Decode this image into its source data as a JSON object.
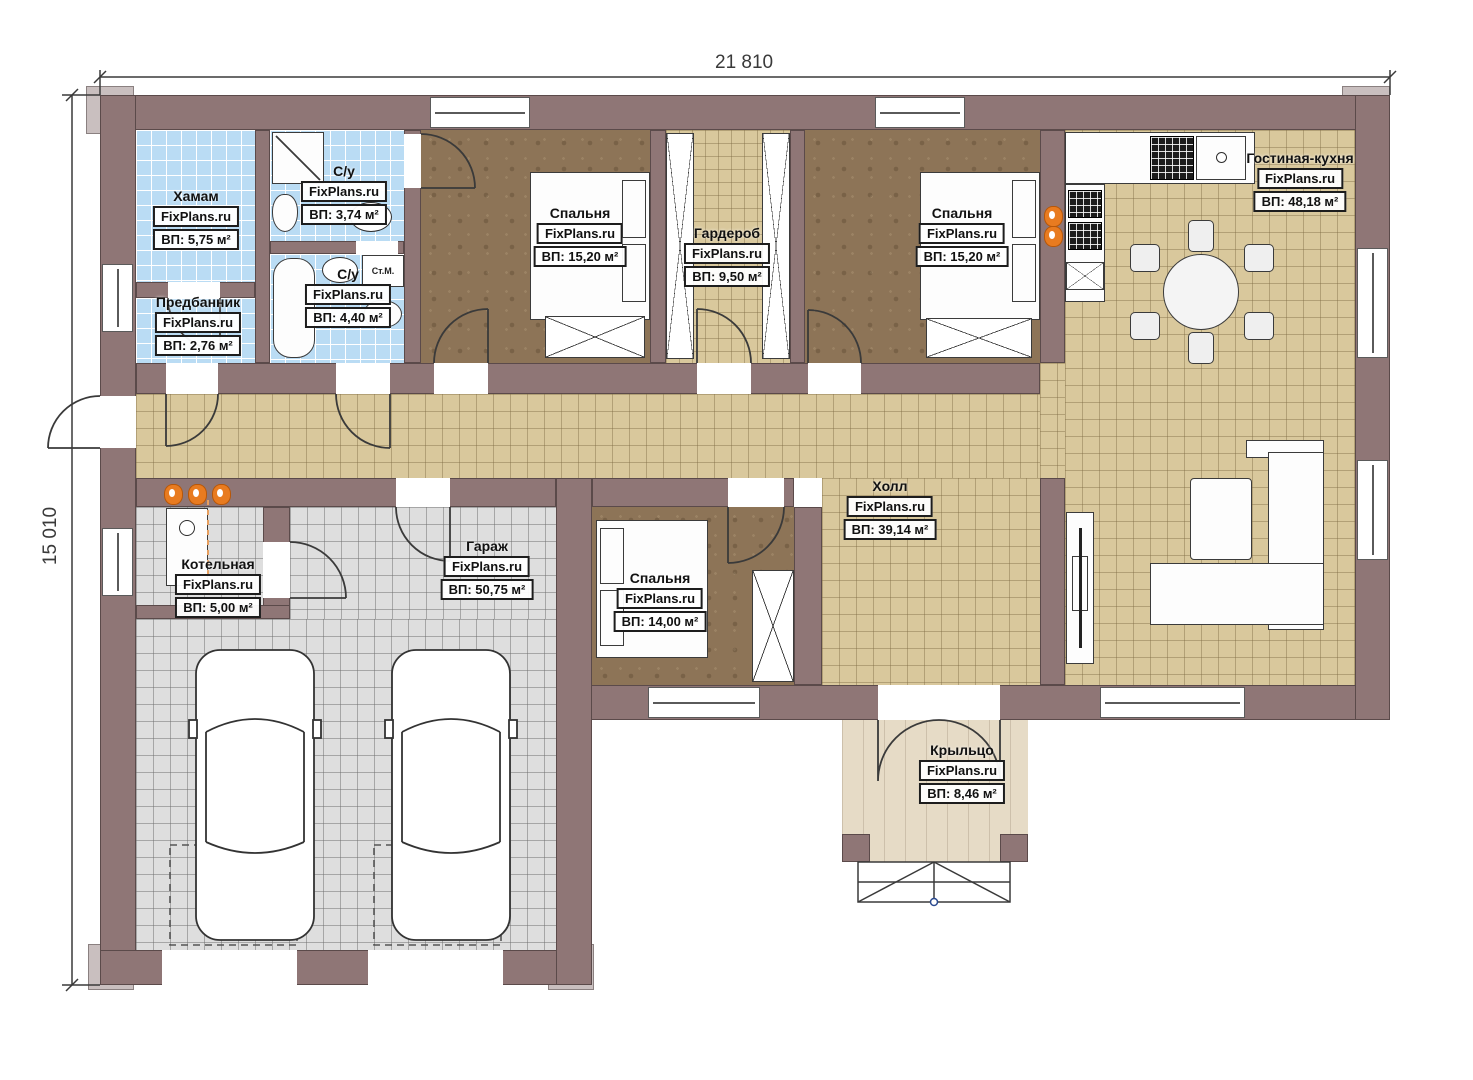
{
  "watermark": "FixPlans.ru",
  "dimensions": {
    "width_label": "21 810",
    "height_label": "15 010"
  },
  "labels": {
    "washing_machine": "Ст.М."
  },
  "colors": {
    "wall": "#8f7676",
    "tile_blue": "#badcf4",
    "floor_tan": "#d9c89c",
    "floor_brown": "#8d7457",
    "floor_gray": "#dedede",
    "porch": "#e6dbc6",
    "radiator": "#e87b20"
  },
  "rooms": [
    {
      "id": "hamam",
      "name": "Хамам",
      "area": "ВП: 5,75 м²"
    },
    {
      "id": "wc-1",
      "name": "С/у",
      "area": "ВП: 3,74 м²"
    },
    {
      "id": "wc-2",
      "name": "С/у",
      "area": "ВП: 4,40 м²"
    },
    {
      "id": "predbannik",
      "name": "Предбанник",
      "area": "ВП: 2,76 м²"
    },
    {
      "id": "bedroom-1",
      "name": "Спальня",
      "area": "ВП: 15,20 м²"
    },
    {
      "id": "wardrobe",
      "name": "Гардероб",
      "area": "ВП: 9,50 м²"
    },
    {
      "id": "bedroom-2",
      "name": "Спальня",
      "area": "ВП: 15,20 м²"
    },
    {
      "id": "living-kitchen",
      "name": "Гостиная-кухня",
      "area": "ВП: 48,18 м²"
    },
    {
      "id": "hall",
      "name": "Холл",
      "area": "ВП: 39,14 м²"
    },
    {
      "id": "boiler-room",
      "name": "Котельная",
      "area": "ВП: 5,00 м²"
    },
    {
      "id": "garage",
      "name": "Гараж",
      "area": "ВП: 50,75 м²"
    },
    {
      "id": "bedroom-3",
      "name": "Спальня",
      "area": "ВП: 14,00 м²"
    },
    {
      "id": "porch",
      "name": "Крыльцо",
      "area": "ВП: 8,46 м²"
    }
  ]
}
